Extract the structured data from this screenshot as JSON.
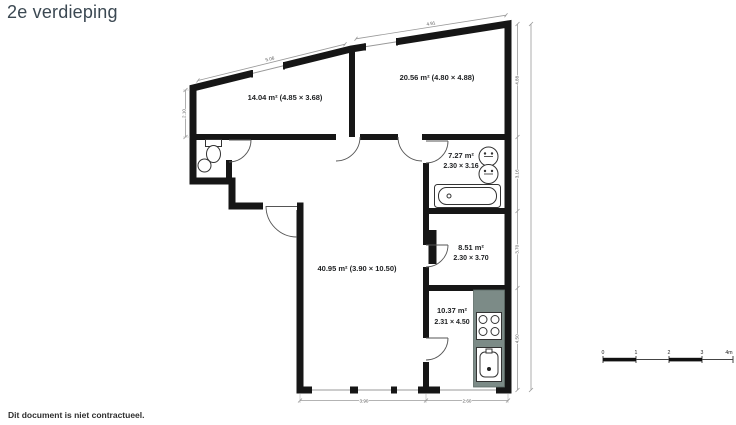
{
  "title": "2e verdieping",
  "footer": "Dit document is niet contractueel.",
  "colors": {
    "wall": "#161616",
    "floor": "#e6e9ea",
    "kitchen_counter": "#7c8b87",
    "title_text": "#3b4852"
  },
  "rooms": [
    {
      "id": "bedroom-left",
      "label": "14.04 m² (4.85 × 3.68)"
    },
    {
      "id": "bedroom-right",
      "label": "20.56 m² (4.80 × 4.88)"
    },
    {
      "id": "bathroom",
      "label": "7.27 m²",
      "dims": "2.30 × 3.16"
    },
    {
      "id": "storage-room",
      "label": "8.51 m²",
      "dims": "2.30 × 3.70"
    },
    {
      "id": "living-room",
      "label": "40.95 m² (3.90 × 10.50)"
    },
    {
      "id": "kitchen",
      "label": "10.37 m²",
      "dims": "2.31 × 4.50"
    }
  ],
  "dimensions": {
    "top_left_roof": "5.06",
    "top_right_roof": "4.91",
    "left_height": "2.10",
    "right_chain": [
      "4.88",
      "3.16",
      "3.70",
      "4.50"
    ],
    "bottom_left": "3.90",
    "bottom_right": "2.60"
  },
  "scale_bar": {
    "ticks": [
      "0",
      "1",
      "2",
      "3",
      "4m"
    ]
  },
  "fixtures": [
    "toilet",
    "hand-basin",
    "bathtub",
    "double-washbasin",
    "duct",
    "kitchen-counter",
    "stove",
    "kitchen-sink"
  ]
}
